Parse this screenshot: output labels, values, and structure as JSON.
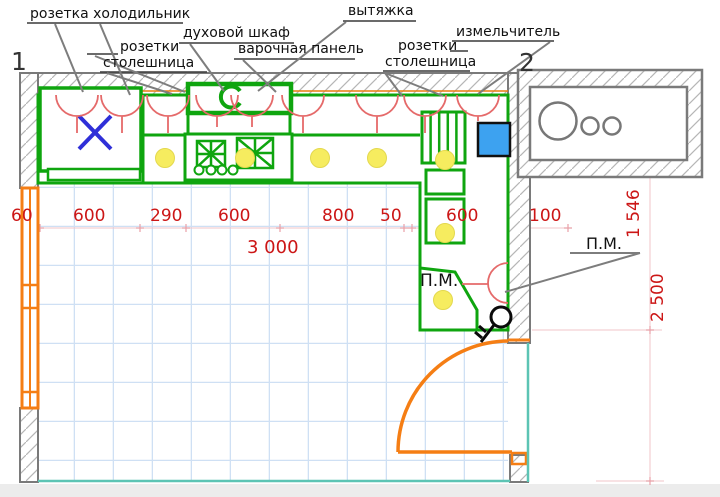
{
  "labels": {
    "fridge_socket": "розетка холодильник",
    "countertop_sockets_left": {
      "line1": "розетки",
      "line2": "столешница"
    },
    "oven": "духовой шкаф",
    "hob": "варочная панель",
    "hood": "вытяжка",
    "countertop_sockets_right": {
      "line1": "розетки",
      "line2": "столешница"
    },
    "grinder": "измельчитель",
    "dishwasher_inside": "П.М.",
    "dishwasher_callout": "П.М.",
    "wall_marker_left": "1",
    "wall_marker_right": "2"
  },
  "dimensions": {
    "window": "60",
    "seg1": "600",
    "seg2": "290",
    "seg3": "600",
    "seg4": "800",
    "seg5": "50",
    "seg6": "600",
    "seg7": "100",
    "total_width": "3 000",
    "right_upper": "1 546",
    "right_total": "2 500"
  },
  "colors": {
    "cabinets_green": "#0fa50f",
    "dimension_red": "#cc1616",
    "socket_red": "#e56a6a",
    "window_door_orange": "#f57e14",
    "room_edge_teal": "#5cc4b4",
    "floor_grid_blue": "#cfe0f4",
    "wall_gray": "#7a7a7a",
    "ceiling_light_yellow": "#f6ec5f",
    "sink_blue": "#3da2f0",
    "fridge_mark_blue": "#2f2fd8"
  }
}
